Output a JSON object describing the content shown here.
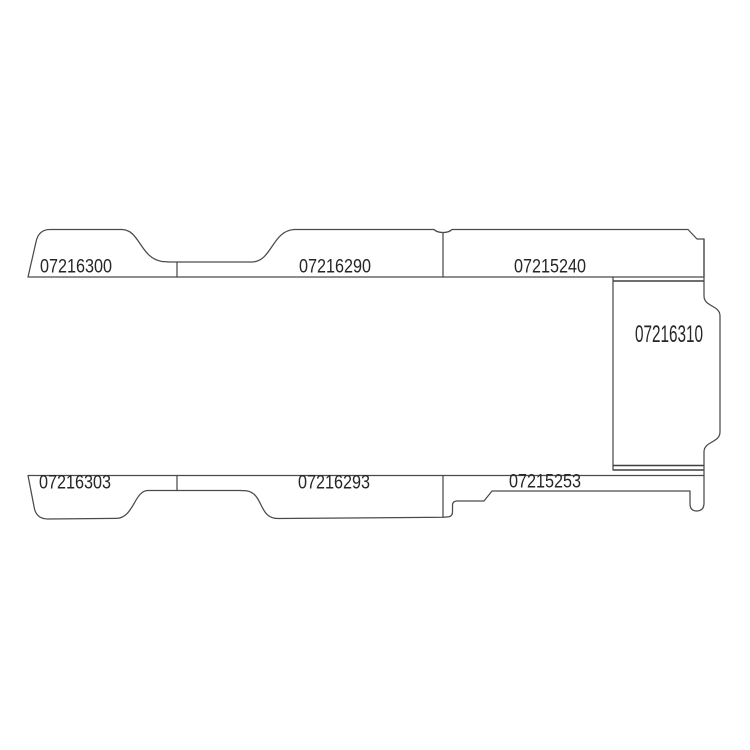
{
  "diagram": {
    "panels": {
      "upper": [
        {
          "part_number": "07216300"
        },
        {
          "part_number": "07216290"
        },
        {
          "part_number": "07215240"
        }
      ],
      "side": {
        "part_number": "07216310"
      },
      "lower": [
        {
          "part_number": "07216303"
        },
        {
          "part_number": "07216293"
        },
        {
          "part_number": "07215253"
        }
      ]
    },
    "colors": {
      "line": "#4a4a4a",
      "text": "#262626",
      "background": "#ffffff"
    }
  }
}
